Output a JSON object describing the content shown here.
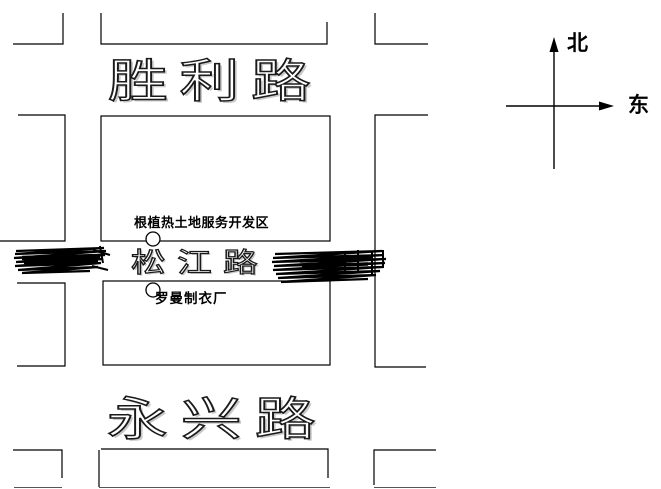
{
  "roads": {
    "shengli": {
      "label": "胜利路"
    },
    "songjiang": {
      "label": "松江路"
    },
    "yongxing": {
      "label": "永兴路"
    }
  },
  "pois": {
    "development_zone": {
      "label": "根植热土地服务开发区",
      "marker": "circle-marker"
    },
    "garment_factory": {
      "label": "罗曼制衣厂",
      "marker": "circle-marker"
    }
  },
  "compass": {
    "north_label": "北",
    "east_label": "东"
  },
  "markers": {
    "scribble_left": "scribble-redaction",
    "scribble_right": "scribble-redaction"
  },
  "colors": {
    "line": "#000000",
    "background": "#ffffff",
    "road_text_fill": "#ffffff",
    "road_text_outline": "#1a1a1a",
    "label_text": "#000000"
  }
}
